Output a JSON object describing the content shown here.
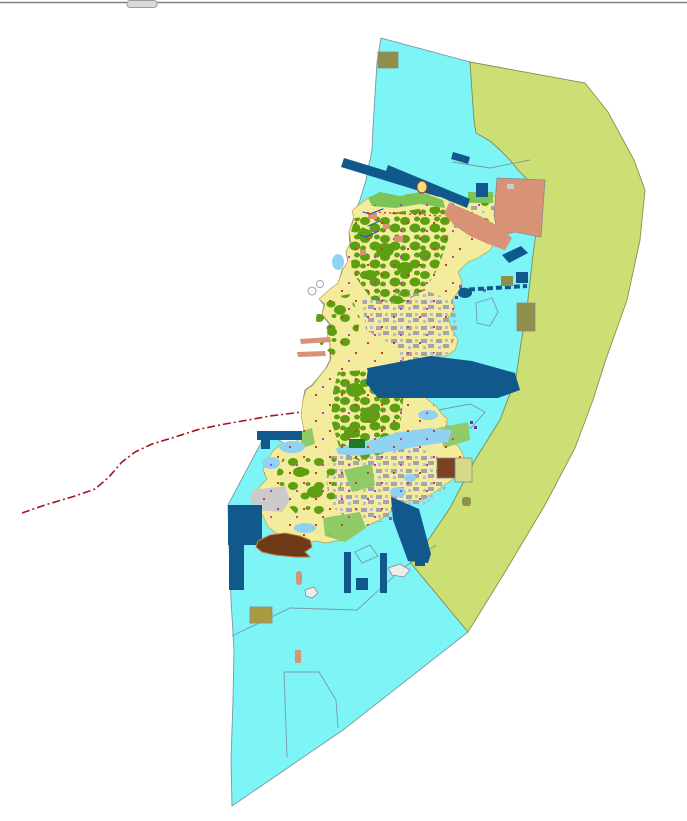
{
  "map": {
    "kind": "land-use zoning map",
    "canvas": {
      "width": 687,
      "height": 821
    },
    "visible_text": [],
    "regions": [
      {
        "id": "coastal-water-zone",
        "color_key": "water",
        "description": "large cyan sea / coastal zone polygon surrounding the island"
      },
      {
        "id": "eastern-buffer-zone",
        "color_key": "outer_zone",
        "description": "olive-green crescent zone along the eastern seaboard"
      },
      {
        "id": "island-landmass",
        "color_key": "island_base",
        "description": "central island with yellow parcels, green forest blobs and gray urban patches"
      },
      {
        "id": "reclamation-area",
        "color_key": "salmon",
        "description": "salmon hook-shaped reclamation area at the island northeast"
      },
      {
        "id": "harbor-structures",
        "color_key": "navy",
        "description": "dark navy harbor basins, breakwater bands and quay rectangles"
      },
      {
        "id": "western-boundary-line",
        "color_key": "red_line",
        "description": "dark red dash-dot boundary line running to the southwest"
      },
      {
        "id": "tidal-flats",
        "color_key": "tidal_blue",
        "description": "light blue tidal inlets along the island coast"
      },
      {
        "id": "facility-rectangles",
        "color_key": "tan_olive",
        "description": "small olive-tan and brown facility rectangles in the sea"
      }
    ]
  },
  "palette": {
    "background": "#FFFFFF",
    "water": "#7DF4F5",
    "water_border": "#7E95A3",
    "outer_zone": "#CCDF75",
    "outer_zone_border": "#85914E",
    "island_base": "#F2EC9C",
    "island_border": "#BBA24D",
    "forest": "#5C9F11",
    "coastal_green": "#7CC455",
    "light_green": "#8FCB66",
    "urban": "#A5A3B1",
    "urban_light": "#BDBBC7",
    "light_gray": "#CBCBCB",
    "salmon": "#D89377",
    "navy": "#11588C",
    "tan_olive": "#8F8F4B",
    "tan_gold": "#A89B41",
    "khaki_pale": "#D6D98A",
    "brown": "#7A4222",
    "brown_dark": "#6E3A17",
    "red_accent": "#D33A2E",
    "magenta": "#C03ACB",
    "purple": "#7B2BB0",
    "red_line": "#A6121F",
    "stream_blue": "#2B50C8",
    "tidal_blue": "#8FD2F2",
    "dark_green": "#1F7A24",
    "bright_green": "#0E9A4E",
    "islet_yellow": "#EFE47A",
    "islet_outline": "#A03828",
    "map_line": "#7A98A6",
    "top_bar": "#808080",
    "top_tab": "#D9D9D9",
    "top_tab_border": "#9E9E9E"
  }
}
